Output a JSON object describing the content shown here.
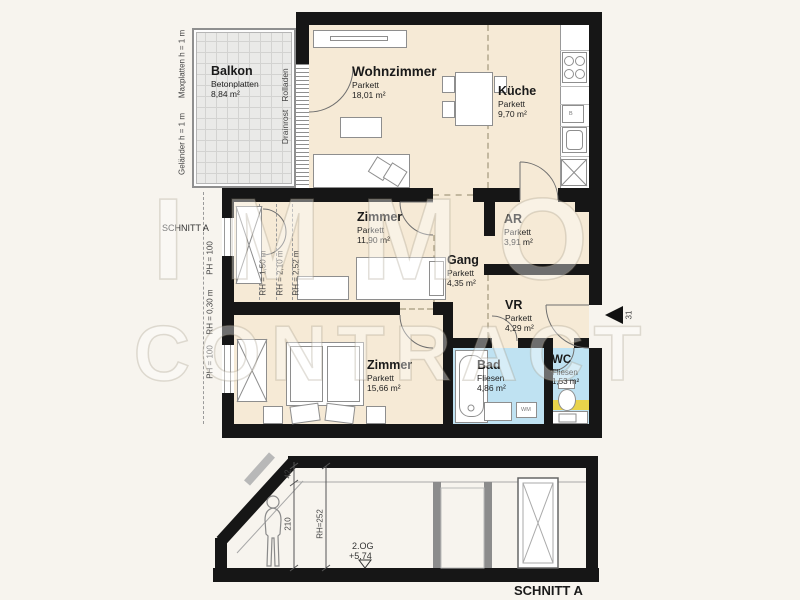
{
  "colors": {
    "wall": "#161616",
    "room_fill": "#f6ead6",
    "wet_room_fill": "#bfe2f2",
    "highlight_yellow": "#e9d34b",
    "balcony_fill": "#eaeae8"
  },
  "watermark": {
    "line1": "IMMO",
    "line2": "CONTRACT"
  },
  "plan": {
    "balcony": {
      "name": "Balkon",
      "material": "Betonplatten",
      "area": "8,84 m²"
    },
    "rooms": {
      "wohnzimmer": {
        "name": "Wohnzimmer",
        "material": "Parkett",
        "area": "18,01 m²"
      },
      "kueche": {
        "name": "Küche",
        "material": "Parkett",
        "area": "9,70 m²"
      },
      "zimmer1": {
        "name": "Zimmer",
        "material": "Parkett",
        "area": "11,90 m²"
      },
      "ar": {
        "name": "AR",
        "material": "Parkett",
        "area": "3,91 m²"
      },
      "gang": {
        "name": "Gang",
        "material": "Parkett",
        "area": "4,35 m²"
      },
      "vr": {
        "name": "VR",
        "material": "Parkett",
        "area": "4,29 m²"
      },
      "zimmer2": {
        "name": "Zimmer",
        "material": "Parkett",
        "area": "15,66 m²"
      },
      "bad": {
        "name": "Bad",
        "material": "Fliesen",
        "area": "4,86 m²"
      },
      "wc": {
        "name": "WC",
        "material": "Fliesen",
        "area": "1,53 m²"
      }
    },
    "annotations": {
      "maxplatten": "Maxplatten h = 1 m",
      "gelaender": "Geländer h = 1 m",
      "rolladen": "Rolladen",
      "drainrost": "Drainrost",
      "schnitt_label": "SCHNITT A",
      "ph_top": "PH = 100",
      "rh_030": "RH = 0,30 m",
      "ph_bottom": "PH = 100",
      "rh_150": "RH = 1,50 m",
      "rh_210": "RH = 2,10 m",
      "rh_252": "RH = 2,52 m",
      "entrance_number": "31",
      "kitchen_unit_label": "B",
      "washing_machine_label": "WM"
    }
  },
  "section": {
    "title": "SCHNITT A",
    "dim_a": "42",
    "dim_b": "210",
    "dim_rh": "RH=252",
    "level_name": "2.OG",
    "level_value": "+5,74"
  }
}
